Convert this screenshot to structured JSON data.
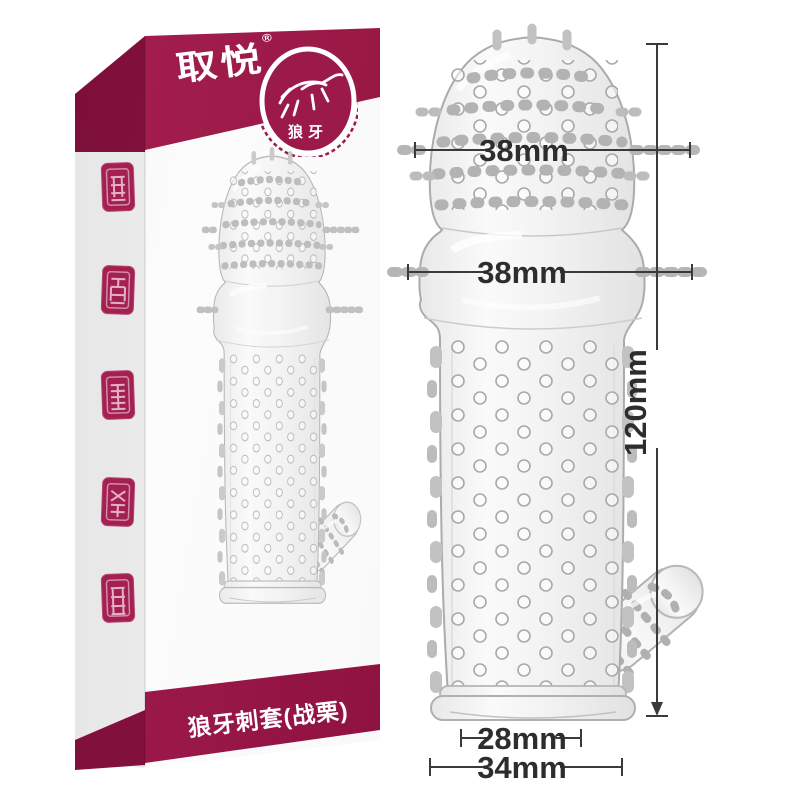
{
  "box": {
    "brand_logo": "取悦",
    "registered_mark": "®",
    "badge_label": "狼牙",
    "product_name": "狼牙刺套(战栗)",
    "seal_stamp_count": 5
  },
  "annotations": {
    "head_width": "38mm",
    "bulge_width": "38mm",
    "length": "120mm",
    "inner_width": "28mm",
    "base_width": "34mm"
  },
  "colors": {
    "brand_maroon": "#9c1a4a",
    "brand_maroon_dark": "#7c0f3a",
    "annotation_line": "#3a3a3a",
    "background": "#ffffff"
  }
}
